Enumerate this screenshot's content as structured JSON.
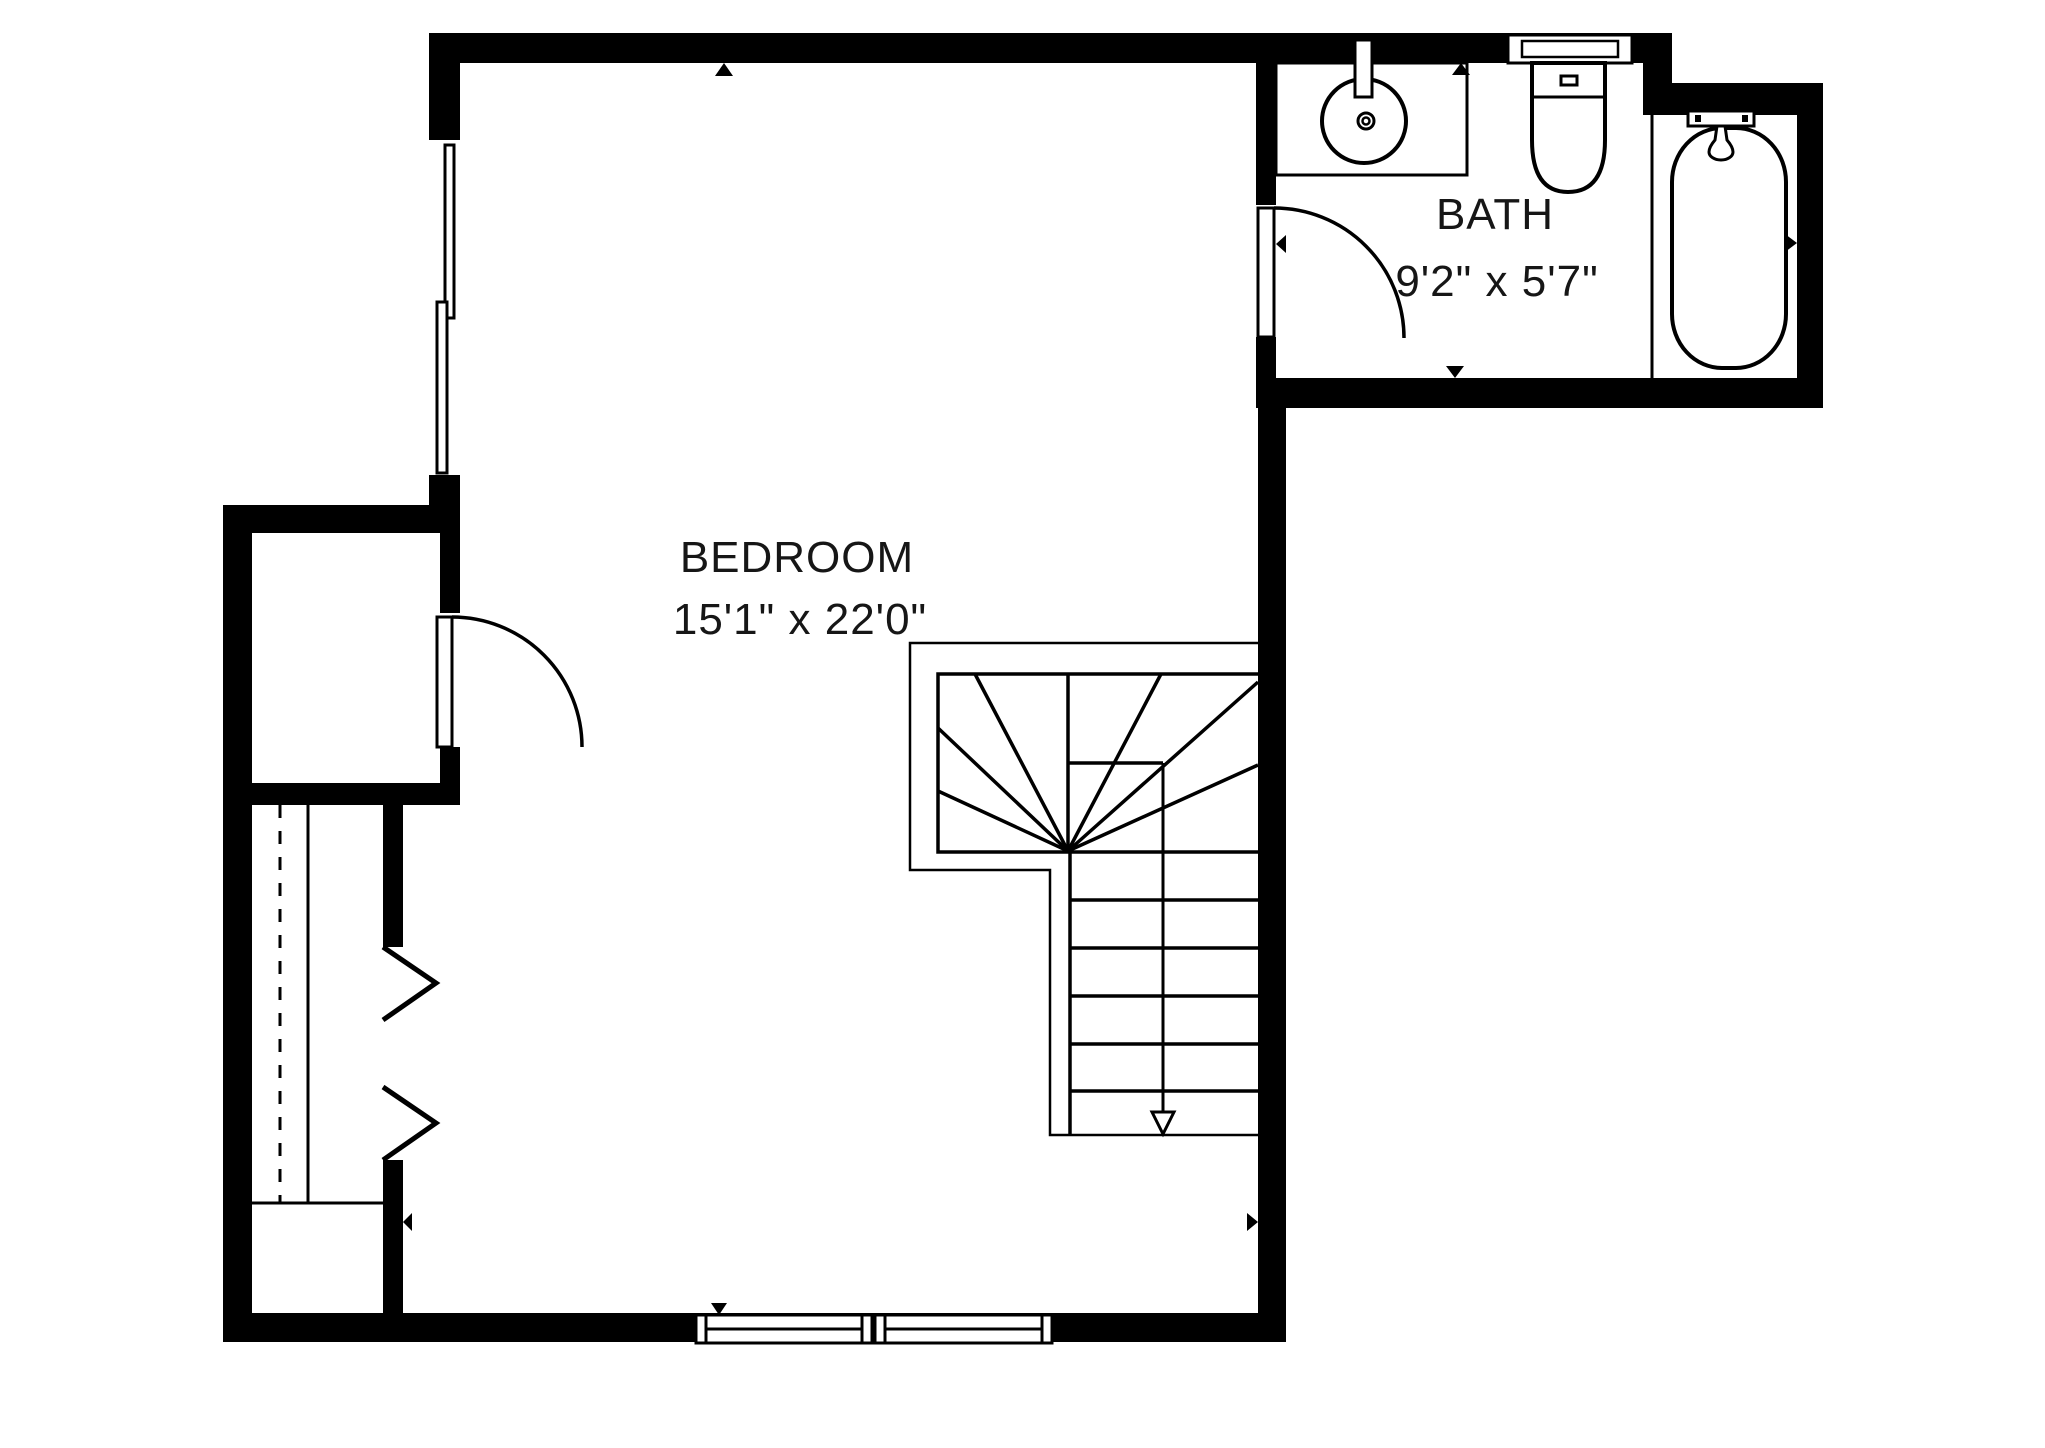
{
  "canvas": {
    "width": 2045,
    "height": 1448,
    "background": "#ffffff",
    "wall_color": "#000000",
    "line_color": "#000000",
    "text_color": "#161616"
  },
  "rooms": [
    {
      "id": "bedroom",
      "name": "BEDROOM",
      "dimensions": "15'1\" x 22'0\""
    },
    {
      "id": "bath",
      "name": "BATH",
      "dimensions": "9'2\" x 5'7\""
    }
  ],
  "fixtures": [
    {
      "name": "vanity-sink",
      "room": "bath"
    },
    {
      "name": "toilet",
      "room": "bath"
    },
    {
      "name": "bathtub",
      "room": "bath"
    },
    {
      "name": "winder-staircase",
      "room": "bedroom"
    },
    {
      "name": "closet",
      "room": "bedroom"
    },
    {
      "name": "wardrobe-bifold-doors",
      "room": "bedroom"
    },
    {
      "name": "closet-swing-door",
      "room": "bedroom"
    },
    {
      "name": "bath-swing-door",
      "room": "bath"
    },
    {
      "name": "window-left",
      "room": "bedroom"
    },
    {
      "name": "window-bottom",
      "room": "bedroom"
    }
  ]
}
